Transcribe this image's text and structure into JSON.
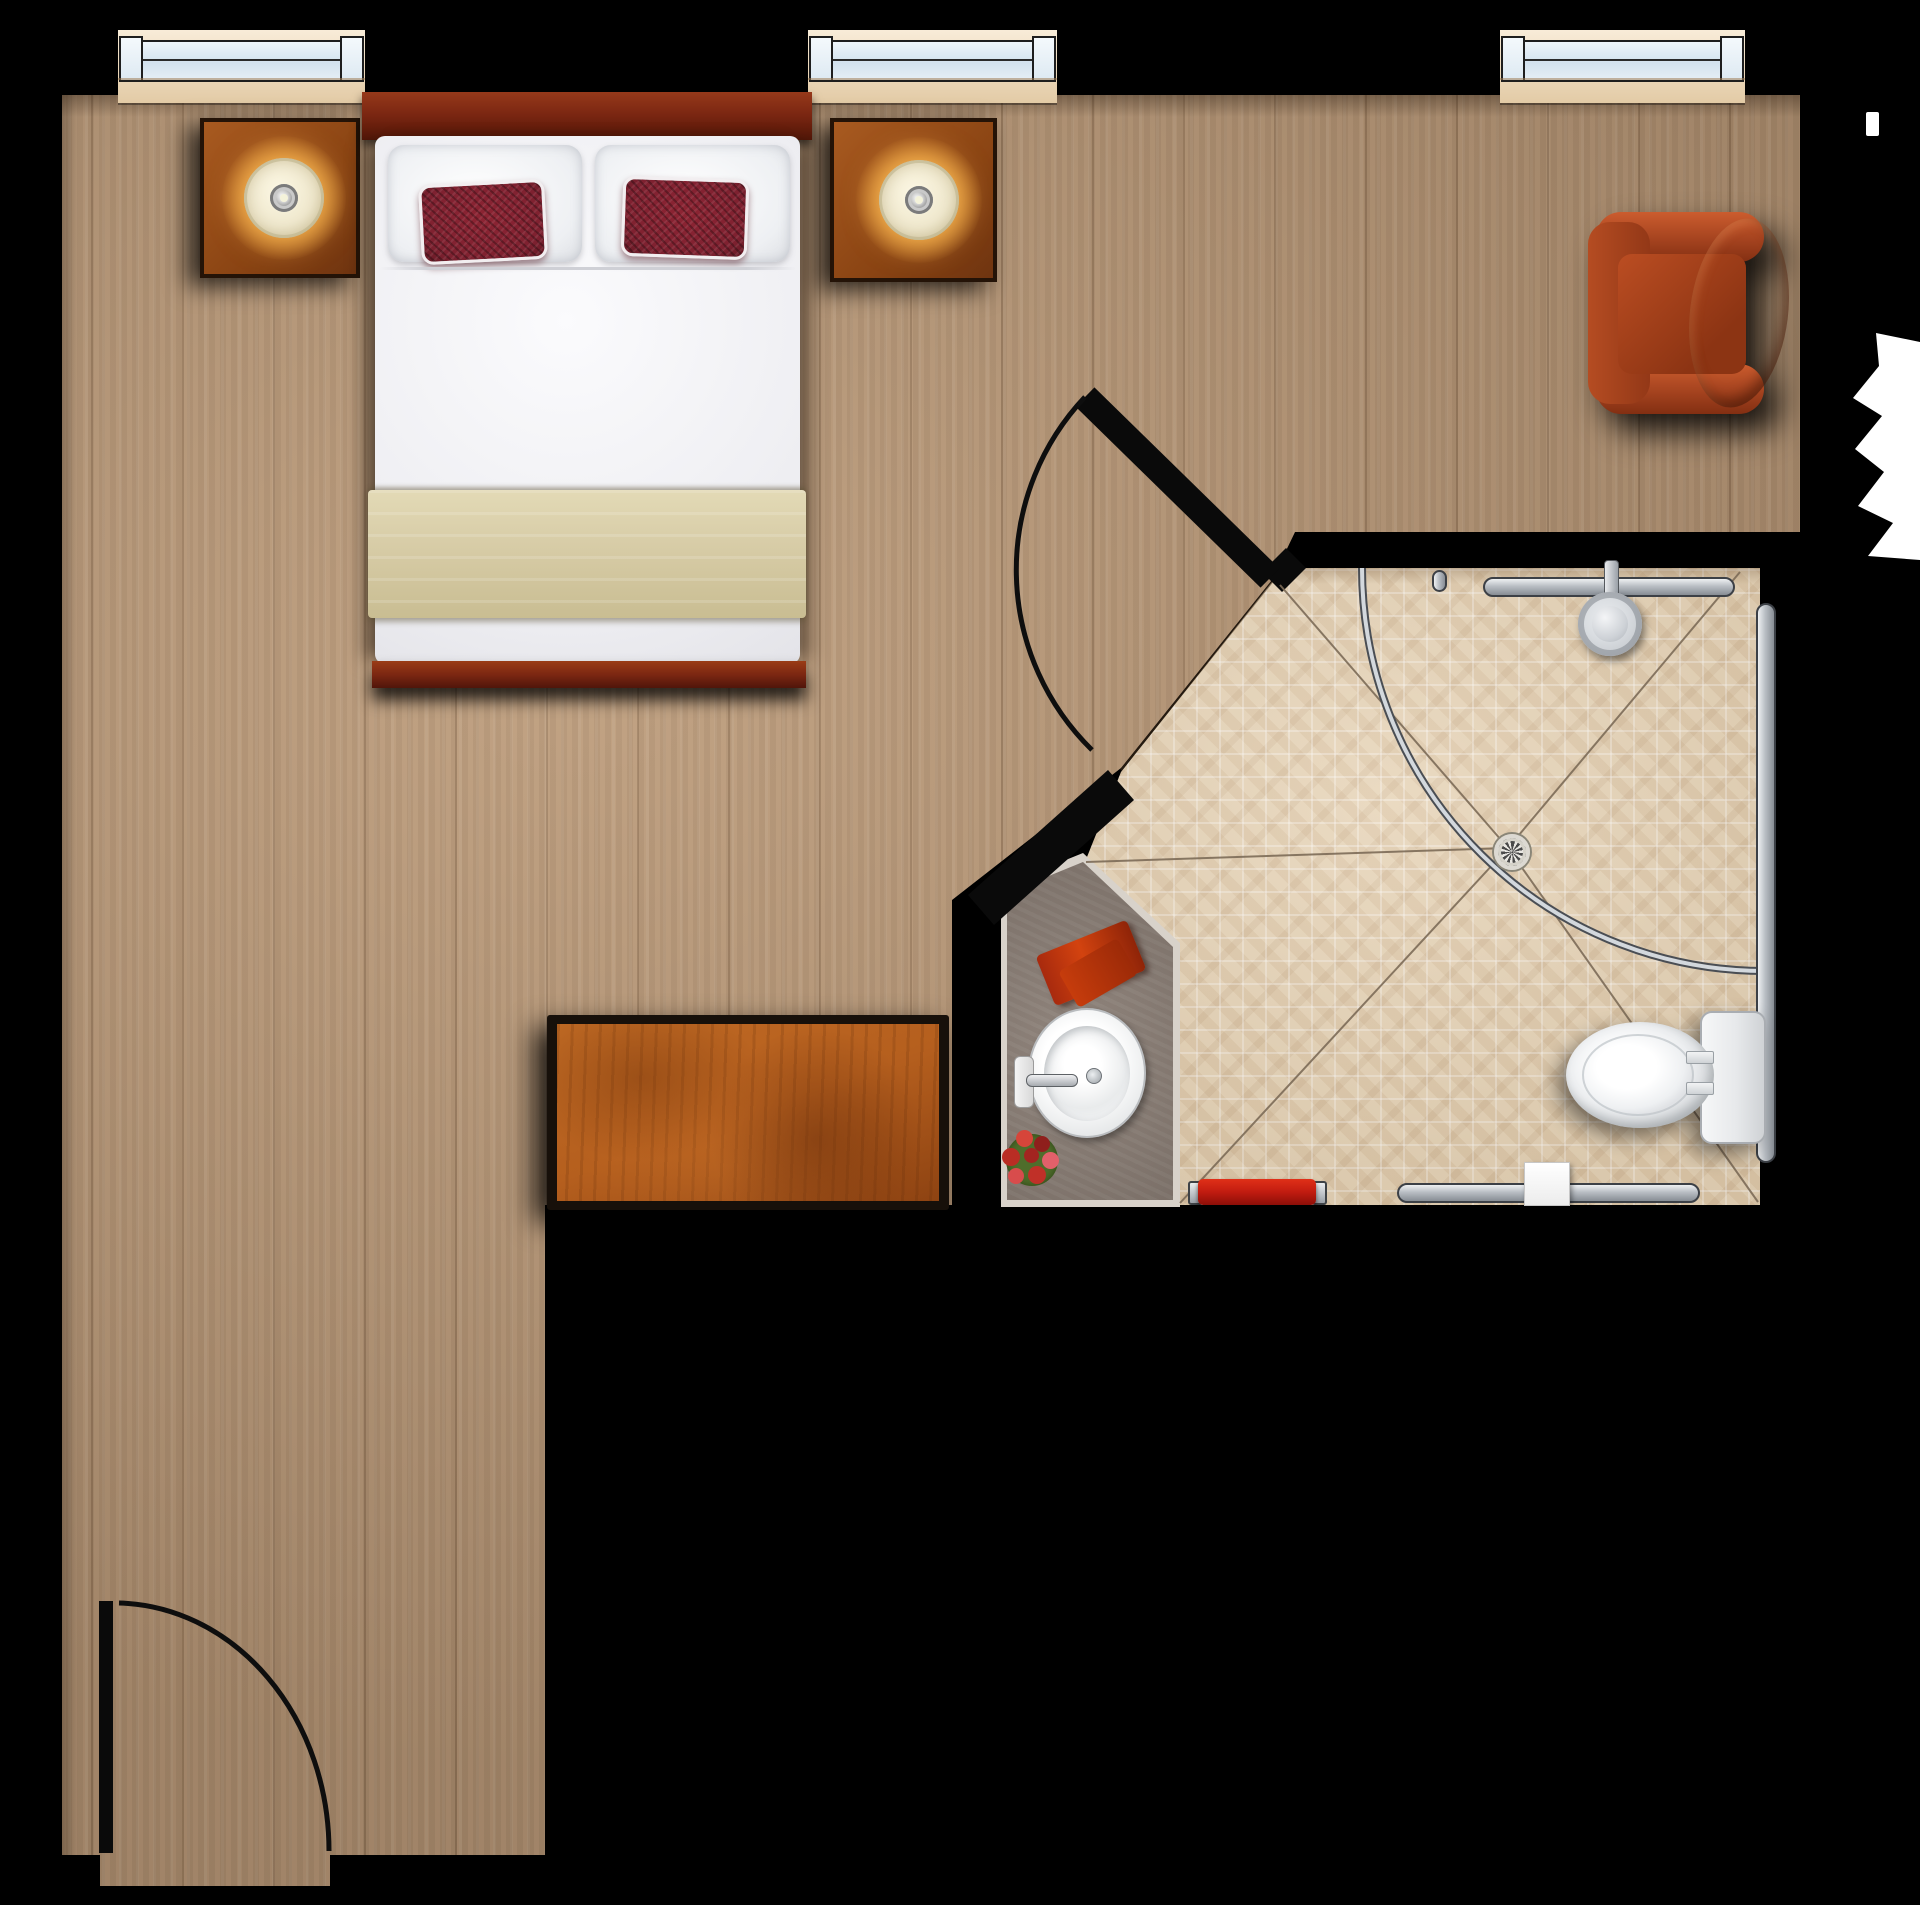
{
  "scene": {
    "kind": "top-down floor plan",
    "rooms": [
      "bedroom",
      "accessible bathroom"
    ]
  },
  "palette": {
    "bg": "#000000",
    "wood": "#bb9a79",
    "tile": "#e6d3b6",
    "counter": "#8a7d74",
    "counter-edge": "#d8d2ca",
    "headboard": "#7c2712",
    "mattress": "#f2f2f5",
    "blanket": "#d8cda8",
    "cushion": "#7e2130",
    "dresser": "#b55f1e",
    "chair": "#b3481f",
    "chrome-light": "#d3d8dd",
    "chrome-dark": "#4a4e54",
    "lamp-shade": "#f1ead0",
    "lamp-glow": "#ffc75e",
    "accent-red": "#c11c10",
    "white": "#ffffff",
    "slope-line": "#7d6c58"
  },
  "objects": {
    "bedroom": [
      "window x3",
      "nightstand with lamp x2",
      "double bed with two white pillows and two dark red cushions",
      "khaki blanket band",
      "leather armchair",
      "wood dresser",
      "entry door with swing arc"
    ],
    "bathroom": [
      "door with swing arc",
      "curved shower curtain rod",
      "shower head",
      "floor drain with slope lines",
      "grab bars x3",
      "vanity counter with oval sink and faucet",
      "red towel on counter",
      "flower bouquet",
      "red towel bar",
      "tissue box",
      "toilet with tank"
    ]
  }
}
